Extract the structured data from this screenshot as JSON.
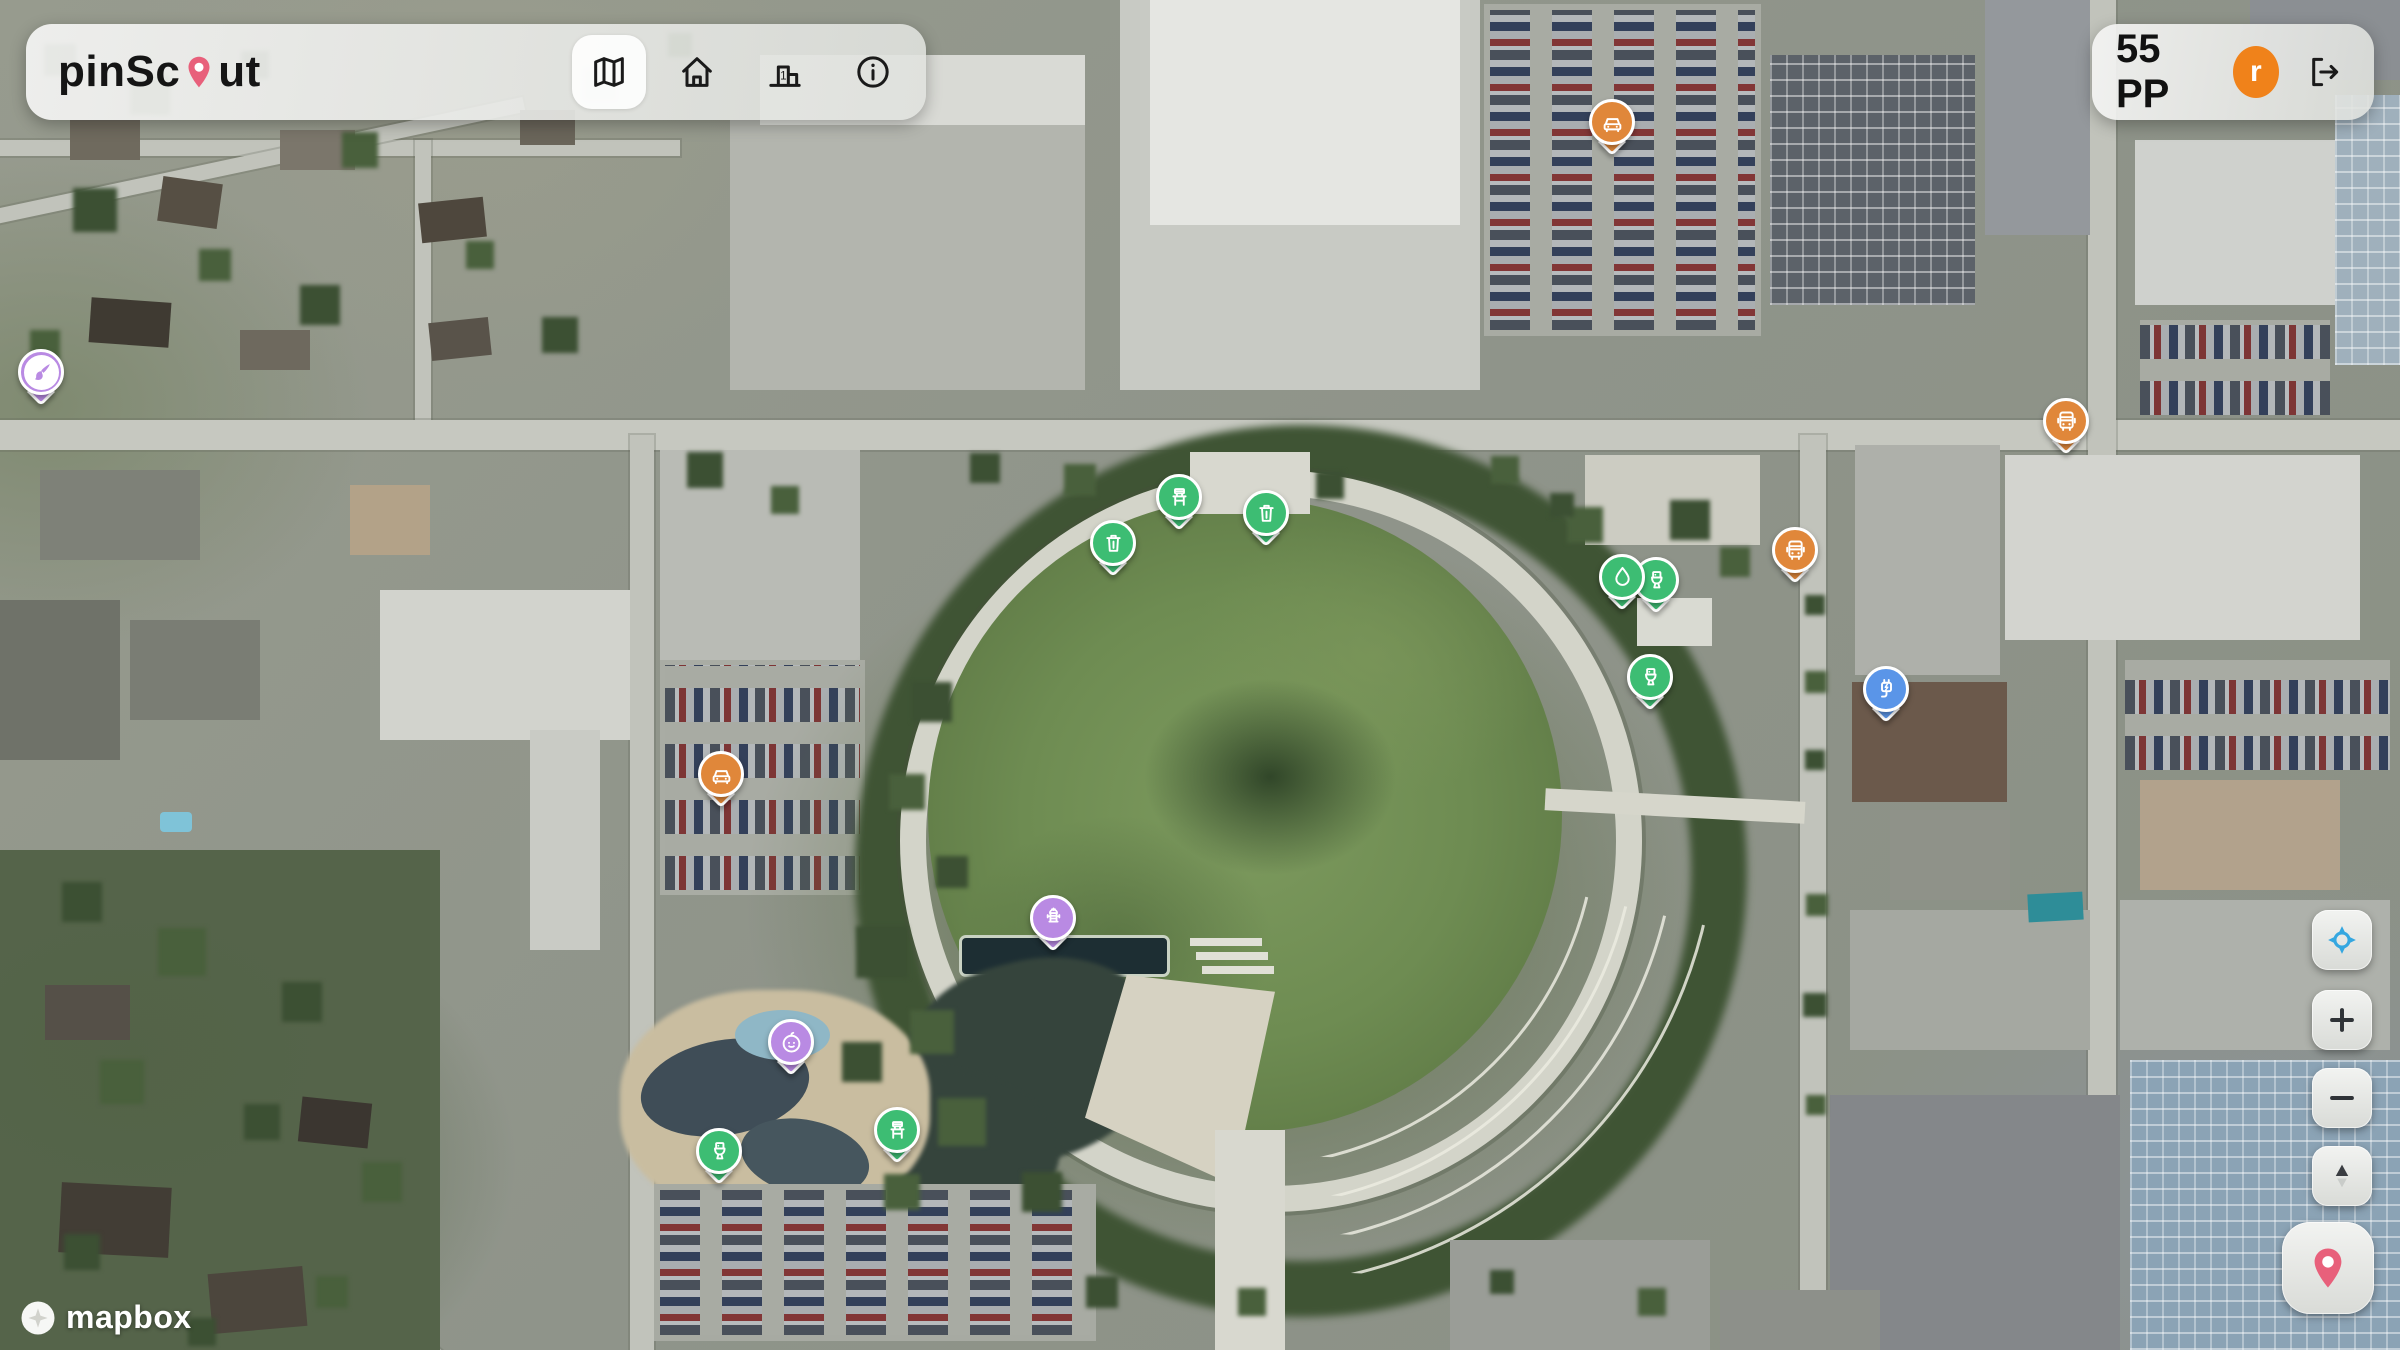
{
  "brand": {
    "pre": "pinSc",
    "post": "ut",
    "pin_color": "#e8607b"
  },
  "nav": [
    {
      "name": "nav-map",
      "icon": "map-icon",
      "active": true
    },
    {
      "name": "nav-home",
      "icon": "home-icon",
      "active": false
    },
    {
      "name": "nav-leaderboard",
      "icon": "leaderboard-icon",
      "active": false
    },
    {
      "name": "nav-info",
      "icon": "info-icon",
      "active": false
    }
  ],
  "user": {
    "points": "55 PP",
    "avatar_initial": "r",
    "avatar_color": "#f0821a"
  },
  "controls": [
    {
      "name": "geolocate-button",
      "icon": "geolocate-icon"
    },
    {
      "name": "zoom-in-button",
      "icon": "plus-icon"
    },
    {
      "name": "zoom-out-button",
      "icon": "minus-icon"
    },
    {
      "name": "compass-button",
      "icon": "compass-icon"
    },
    {
      "name": "add-pin-button",
      "icon": "pin-icon"
    }
  ],
  "attribution": {
    "label": "mapbox"
  },
  "colors": {
    "green": "#3dbd73",
    "orange": "#e0873a",
    "purple": "#b98ae3",
    "blue": "#5a95e8",
    "pink": "#e8607b"
  },
  "pins": [
    {
      "type": "art",
      "icon": "paintbrush-icon",
      "color": "#b98ae3",
      "style": "inset",
      "x": 41,
      "y": 372
    },
    {
      "type": "parking",
      "icon": "car-icon",
      "color": "#e0873a",
      "x": 1612,
      "y": 122
    },
    {
      "type": "bus-stop",
      "icon": "bus-icon",
      "color": "#e0873a",
      "x": 2066,
      "y": 421
    },
    {
      "type": "bus-stop",
      "icon": "bus-icon",
      "color": "#e0873a",
      "x": 1795,
      "y": 550
    },
    {
      "type": "bench",
      "icon": "bench-icon",
      "color": "#3dbd73",
      "x": 1179,
      "y": 497
    },
    {
      "type": "trash",
      "icon": "trash-icon",
      "color": "#3dbd73",
      "x": 1266,
      "y": 513
    },
    {
      "type": "trash",
      "icon": "trash-icon",
      "color": "#3dbd73",
      "x": 1113,
      "y": 543
    },
    {
      "type": "restroom",
      "icon": "toilet-icon",
      "color": "#3dbd73",
      "x": 1656,
      "y": 580
    },
    {
      "type": "water-fountain",
      "icon": "water-icon",
      "color": "#3dbd73",
      "x": 1622,
      "y": 577
    },
    {
      "type": "restroom",
      "icon": "toilet-icon",
      "color": "#3dbd73",
      "x": 1650,
      "y": 677
    },
    {
      "type": "ev-charger",
      "icon": "ev-icon",
      "color": "#5a95e8",
      "x": 1886,
      "y": 689
    },
    {
      "type": "parking",
      "icon": "car-icon",
      "color": "#e0873a",
      "x": 721,
      "y": 774
    },
    {
      "type": "fountain",
      "icon": "fountain-icon",
      "color": "#b98ae3",
      "x": 1053,
      "y": 918
    },
    {
      "type": "playground",
      "icon": "baby-icon",
      "color": "#b98ae3",
      "x": 791,
      "y": 1042
    },
    {
      "type": "bench",
      "icon": "bench-icon",
      "color": "#3dbd73",
      "x": 897,
      "y": 1130
    },
    {
      "type": "restroom",
      "icon": "toilet-icon",
      "color": "#3dbd73",
      "x": 719,
      "y": 1151
    }
  ]
}
